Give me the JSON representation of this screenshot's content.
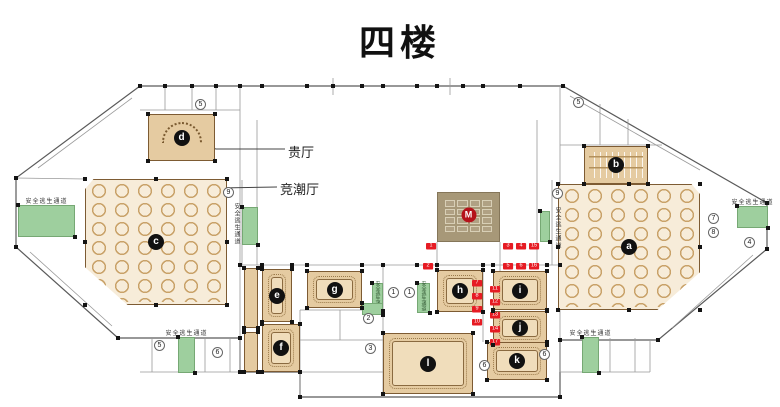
{
  "title": "四楼",
  "annotations": {
    "vip_hall": {
      "label": "贵厅"
    },
    "jingchao_hall": {
      "label": "竞潮厅"
    }
  },
  "escape_route_label": "安全逃生通道",
  "m_box": {
    "label": "M"
  },
  "colors": {
    "room_fill": "#e5cba1",
    "banquet_fill": "#f7ecd9",
    "table_ring": "#c9a269",
    "escape_green": "#9ecf9e",
    "route_red": "#e61b23",
    "m_box_fill": "#a79878",
    "m_badge_red": "#b5121b",
    "badge_black": "#111111",
    "wall": "#8a8a8a"
  },
  "rooms": [
    {
      "id": "a",
      "label": "a",
      "type": "banquet",
      "x": 558,
      "y": 184,
      "w": 142,
      "h": 126,
      "clip": "right"
    },
    {
      "id": "b",
      "label": "b",
      "type": "rows",
      "x": 584,
      "y": 146,
      "w": 64,
      "h": 38
    },
    {
      "id": "c",
      "label": "c",
      "type": "banquet",
      "x": 85,
      "y": 179,
      "w": 142,
      "h": 126,
      "clip": "left"
    },
    {
      "id": "d",
      "label": "d",
      "type": "ushape",
      "x": 148,
      "y": 114,
      "w": 67,
      "h": 47
    },
    {
      "id": "e",
      "label": "e",
      "type": "conf",
      "x": 262,
      "y": 269,
      "w": 30,
      "h": 53
    },
    {
      "id": "f",
      "label": "f",
      "type": "conf",
      "x": 262,
      "y": 324,
      "w": 38,
      "h": 48
    },
    {
      "id": "g",
      "label": "g",
      "type": "conf",
      "x": 307,
      "y": 271,
      "w": 55,
      "h": 37
    },
    {
      "id": "h",
      "label": "h",
      "type": "conf",
      "x": 437,
      "y": 270,
      "w": 46,
      "h": 42
    },
    {
      "id": "i",
      "label": "i",
      "type": "conf",
      "x": 493,
      "y": 271,
      "w": 54,
      "h": 39
    },
    {
      "id": "j",
      "label": "j",
      "type": "conf",
      "x": 493,
      "y": 311,
      "w": 54,
      "h": 34
    },
    {
      "id": "k",
      "label": "k",
      "type": "conf",
      "x": 487,
      "y": 342,
      "w": 60,
      "h": 38
    },
    {
      "id": "l",
      "label": "l",
      "type": "conf",
      "x": 383,
      "y": 333,
      "w": 90,
      "h": 61
    },
    {
      "id": "service-top",
      "label": "",
      "type": "strip",
      "x": 244,
      "y": 268,
      "w": 14,
      "h": 60
    },
    {
      "id": "service-bottom",
      "label": "",
      "type": "strip",
      "x": 244,
      "y": 332,
      "w": 14,
      "h": 40
    }
  ],
  "escape_bars": [
    {
      "x": 18,
      "y": 205,
      "w": 57,
      "h": 32,
      "text_pos": "above"
    },
    {
      "x": 242,
      "y": 207,
      "w": 16,
      "h": 38,
      "text_pos": "left"
    },
    {
      "x": 372,
      "y": 283,
      "w": 11,
      "h": 28,
      "text_pos": "on"
    },
    {
      "x": 362,
      "y": 303,
      "w": 21,
      "h": 12,
      "text_pos": "none"
    },
    {
      "x": 417,
      "y": 283,
      "w": 13,
      "h": 30,
      "text_pos": "on"
    },
    {
      "x": 540,
      "y": 211,
      "w": 10,
      "h": 31,
      "text_pos": "right"
    },
    {
      "x": 737,
      "y": 206,
      "w": 31,
      "h": 22,
      "text_pos": "above"
    },
    {
      "x": 178,
      "y": 337,
      "w": 17,
      "h": 36,
      "text_pos": "above"
    },
    {
      "x": 582,
      "y": 337,
      "w": 17,
      "h": 36,
      "text_pos": "above"
    }
  ],
  "circled_markers": [
    {
      "n": "5",
      "x": 195,
      "y": 99
    },
    {
      "n": "9",
      "x": 223,
      "y": 187
    },
    {
      "n": "1",
      "x": 388,
      "y": 287
    },
    {
      "n": "1",
      "x": 404,
      "y": 287
    },
    {
      "n": "2",
      "x": 363,
      "y": 313
    },
    {
      "n": "3",
      "x": 365,
      "y": 343
    },
    {
      "n": "5",
      "x": 573,
      "y": 97
    },
    {
      "n": "9",
      "x": 552,
      "y": 188
    },
    {
      "n": "7",
      "x": 708,
      "y": 213
    },
    {
      "n": "8",
      "x": 708,
      "y": 227
    },
    {
      "n": "4",
      "x": 744,
      "y": 237
    },
    {
      "n": "6",
      "x": 212,
      "y": 347
    },
    {
      "n": "5",
      "x": 154,
      "y": 340
    },
    {
      "n": "6",
      "x": 539,
      "y": 349
    },
    {
      "n": "6",
      "x": 479,
      "y": 360
    }
  ],
  "route_markers": [
    {
      "n": "1",
      "x": 426,
      "y": 243
    },
    {
      "n": "2",
      "x": 423,
      "y": 263
    },
    {
      "n": "3",
      "x": 503,
      "y": 243
    },
    {
      "n": "4",
      "x": 516,
      "y": 243
    },
    {
      "n": "15",
      "x": 529,
      "y": 243
    },
    {
      "n": "5",
      "x": 503,
      "y": 263
    },
    {
      "n": "6",
      "x": 516,
      "y": 263
    },
    {
      "n": "16",
      "x": 529,
      "y": 263
    },
    {
      "n": "7",
      "x": 472,
      "y": 280
    },
    {
      "n": "8",
      "x": 472,
      "y": 293
    },
    {
      "n": "9",
      "x": 472,
      "y": 306
    },
    {
      "n": "10",
      "x": 472,
      "y": 319
    },
    {
      "n": "11",
      "x": 490,
      "y": 286
    },
    {
      "n": "12",
      "x": 490,
      "y": 299
    },
    {
      "n": "13",
      "x": 490,
      "y": 312
    },
    {
      "n": "14",
      "x": 490,
      "y": 326
    },
    {
      "n": "17",
      "x": 490,
      "y": 339
    }
  ]
}
